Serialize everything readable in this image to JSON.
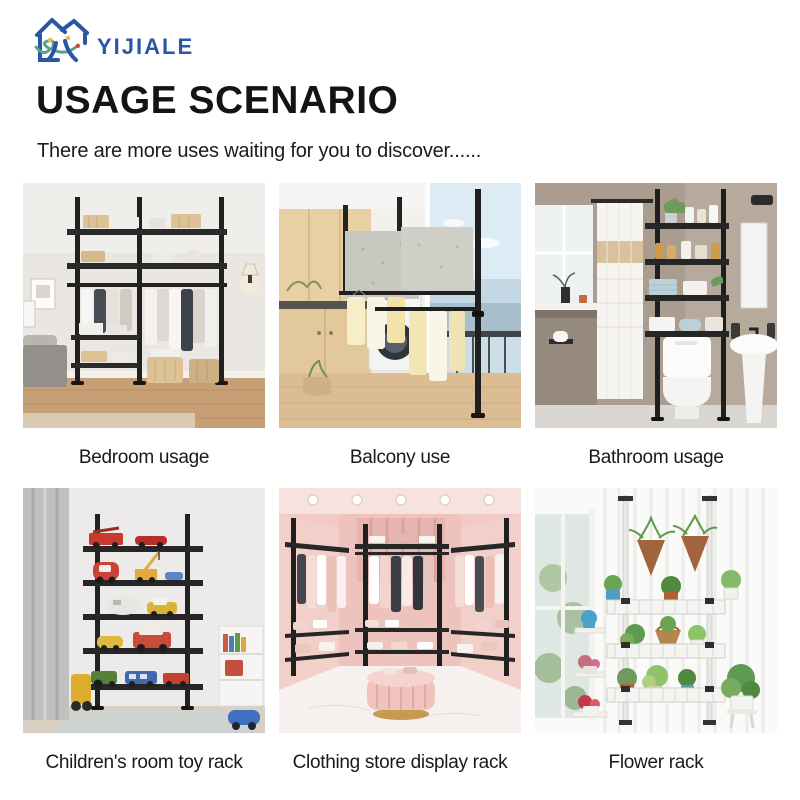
{
  "logo": {
    "brand": "YIJIALE"
  },
  "header": {
    "title": "USAGE SCENARIO",
    "subtitle": "There are more uses waiting for you to discover......"
  },
  "colors": {
    "logo_blue": "#2a56a5",
    "logo_green": "#5aa08b",
    "logo_yellow": "#e5c23c",
    "title_black": "#141414",
    "rack_black": "#212121"
  },
  "scenarios": [
    {
      "caption": "Bedroom usage"
    },
    {
      "caption": "Balcony use"
    },
    {
      "caption": "Bathroom usage"
    },
    {
      "caption": "Children's room toy rack"
    },
    {
      "caption": "Clothing store display rack"
    },
    {
      "caption": "Flower rack"
    }
  ]
}
